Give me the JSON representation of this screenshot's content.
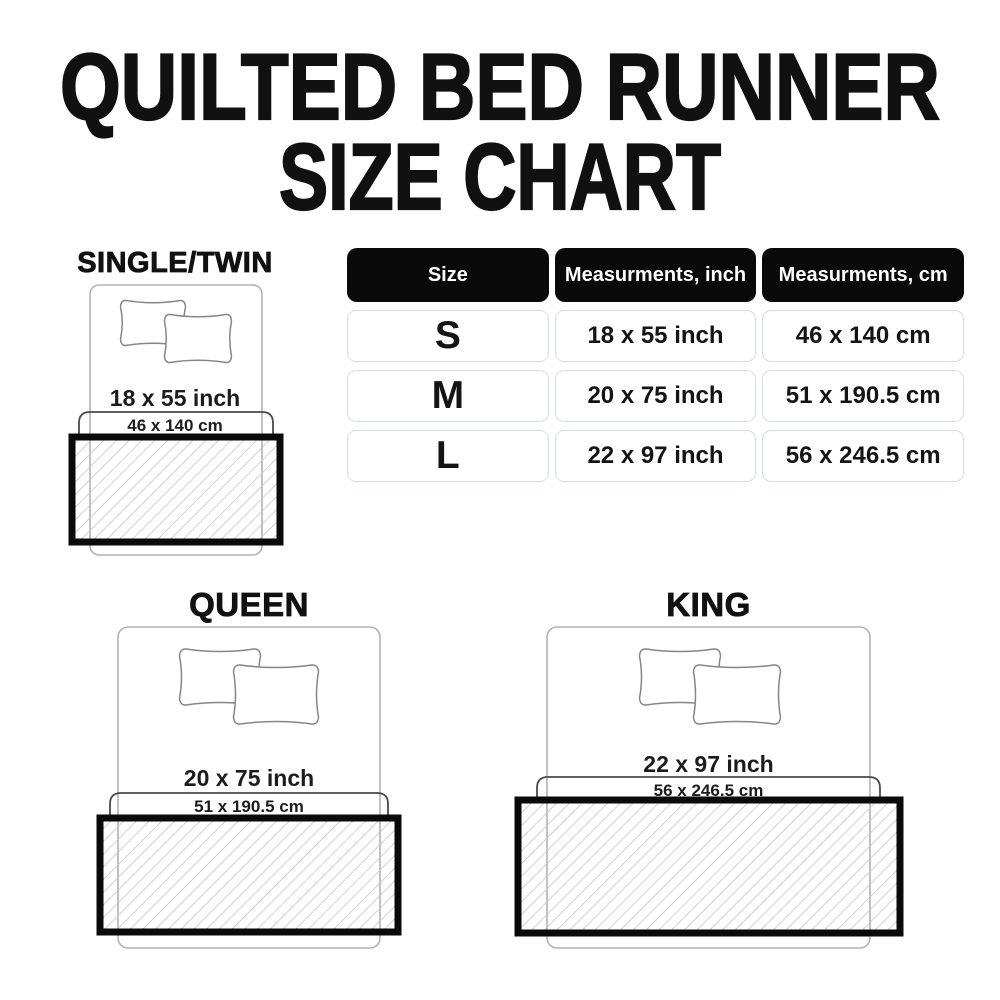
{
  "title": {
    "line1": "QUILTED BED RUNNER",
    "line2": "SIZE CHART"
  },
  "table": {
    "headers": [
      "Size",
      "Measurments, inch",
      "Measurments, cm"
    ],
    "rows": [
      {
        "size": "S",
        "inch": "18 x 55 inch",
        "cm": "46 x 140 cm"
      },
      {
        "size": "M",
        "inch": "20 x 75 inch",
        "cm": "51 x 190.5 cm"
      },
      {
        "size": "L",
        "inch": "22 x 97 inch",
        "cm": "56 x 246.5 cm"
      }
    ]
  },
  "diagrams": [
    {
      "name": "SINGLE/TWIN",
      "inch": "18 x 55 inch",
      "cm": "46 x 140 cm"
    },
    {
      "name": "QUEEN",
      "inch": "20 x 75 inch",
      "cm": "51 x 190.5 cm"
    },
    {
      "name": "KING",
      "inch": "22 x 97 inch",
      "cm": "56 x 246.5 cm"
    }
  ],
  "colors": {
    "text": "#111111",
    "header_bg": "#0a0a0a",
    "header_text": "#ffffff",
    "cell_border": "#d9dee1",
    "bed_outline": "#b2b2b2",
    "pillow_outline": "#868686",
    "bracket": "#4a4a4a",
    "runner_border": "#0a0a0a",
    "hatch": "#c6c6c6"
  }
}
